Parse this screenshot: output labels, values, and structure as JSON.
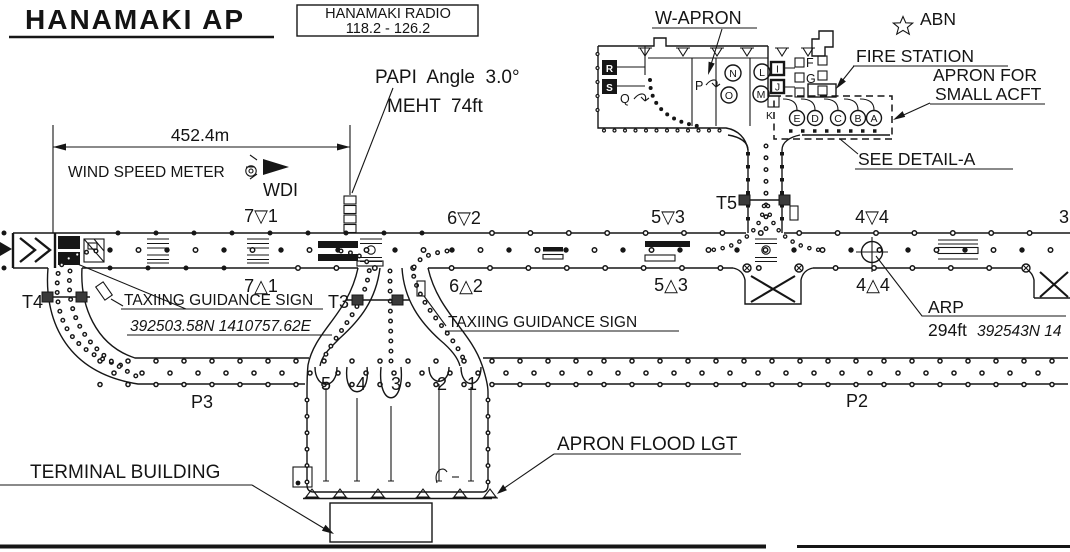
{
  "title": "HANAMAKI AP",
  "radio_box": {
    "line1": "HANAMAKI RADIO",
    "line2": "118.2 - 126.2"
  },
  "papi": {
    "line1": "PAPI  Angle  3.0°",
    "line2": "MEHT  74ft"
  },
  "dimension": {
    "label": "452.4m"
  },
  "wind": {
    "meter": "WIND SPEED METER",
    "wdi": "WDI"
  },
  "beacon": {
    "label": "ABN"
  },
  "fire_station": {
    "label": "FIRE STATION"
  },
  "small_apron": {
    "line1": "APRON FOR",
    "line2": "SMALL ACFT"
  },
  "detail": {
    "label": "SEE DETAIL-A"
  },
  "w_apron": {
    "label": "W-APRON"
  },
  "arp": {
    "label": "ARP",
    "elevation": "294ft",
    "coordinates": "392543N 14"
  },
  "signs": {
    "sign1": "TAXIING GUIDANCE SIGN",
    "sign1_coordinates": "392503.58N 1410757.62E",
    "sign2": "TAXIING GUIDANCE SIGN"
  },
  "terminal": {
    "label": "TERMINAL BUILDING"
  },
  "flood": {
    "label": "APRON FLOOD LGT"
  },
  "aprons": {
    "p2": "P2",
    "p3": "P3"
  },
  "taxiways": {
    "t3": "T3",
    "t4": "T4",
    "t5": "T5"
  },
  "runway_marks": {
    "top": [
      "7▽1",
      "6▽2",
      "5▽3",
      "4▽4",
      "3"
    ],
    "bottom": [
      "7△1",
      "6△2",
      "5△3",
      "4△4"
    ]
  },
  "stands": [
    "5",
    "4",
    "3",
    "2",
    "1"
  ],
  "positions": {
    "r": "R",
    "s": "S",
    "q": "Q",
    "p": "P",
    "n": "N",
    "o": "O",
    "l": "L",
    "m": "M",
    "i": "I",
    "j": "J",
    "k": "K",
    "f": "F",
    "g": "G",
    "small": [
      "E",
      "D",
      "C",
      "B",
      "A"
    ]
  }
}
